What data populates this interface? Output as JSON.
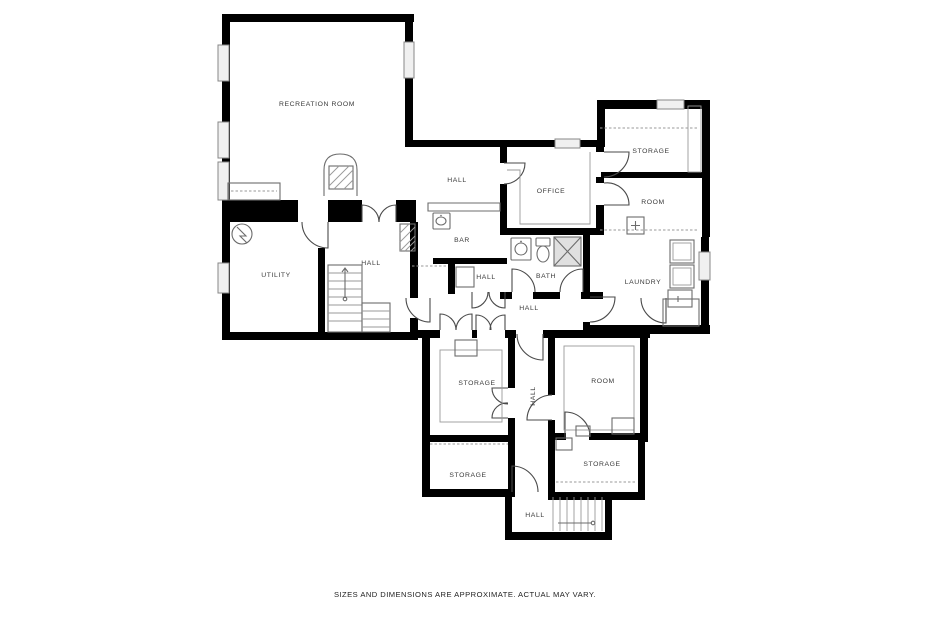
{
  "title": "Basement floor plan",
  "rooms": {
    "recreation_room": {
      "label": "RECREATION ROOM"
    },
    "hall_upper": {
      "label": "HALL"
    },
    "office": {
      "label": "OFFICE"
    },
    "storage_ne": {
      "label": "STORAGE"
    },
    "room_ne": {
      "label": "ROOM"
    },
    "bar": {
      "label": "BAR"
    },
    "hall_closet": {
      "label": "HALL"
    },
    "bath": {
      "label": "BATH"
    },
    "laundry": {
      "label": "LAUNDRY"
    },
    "utility": {
      "label": "UTILITY"
    },
    "hall_stairs": {
      "label": "HALL"
    },
    "hall_main": {
      "label": "HALL"
    },
    "storage_ml": {
      "label": "STORAGE"
    },
    "storage_bl": {
      "label": "STORAGE"
    },
    "hall_vert": {
      "label": "HALL"
    },
    "room_br": {
      "label": "ROOM"
    },
    "storage_se": {
      "label": "STORAGE"
    },
    "hall_entry": {
      "label": "HALL"
    }
  },
  "fixtures": {
    "fireplace": "fireplace with hatched hearth",
    "bar_counter": "bar counter with sink",
    "bath_sink": "bathroom sink",
    "toilet": "toilet",
    "shower": "shower stall (X)",
    "washer_dryer": "stacked laundry appliances",
    "water_heater": "water heater symbol",
    "stairs_main": "staircase up",
    "stairs_entry": "entry staircase"
  },
  "footer": {
    "disclaimer": "SIZES AND DIMENSIONS ARE APPROXIMATE. ACTUAL MAY VARY."
  },
  "colors": {
    "wall": "#000000",
    "label_text": "#3a3a3a",
    "door_line": "#4a4a4a",
    "window_fill": "#f0f0f0",
    "background": "#ffffff"
  }
}
